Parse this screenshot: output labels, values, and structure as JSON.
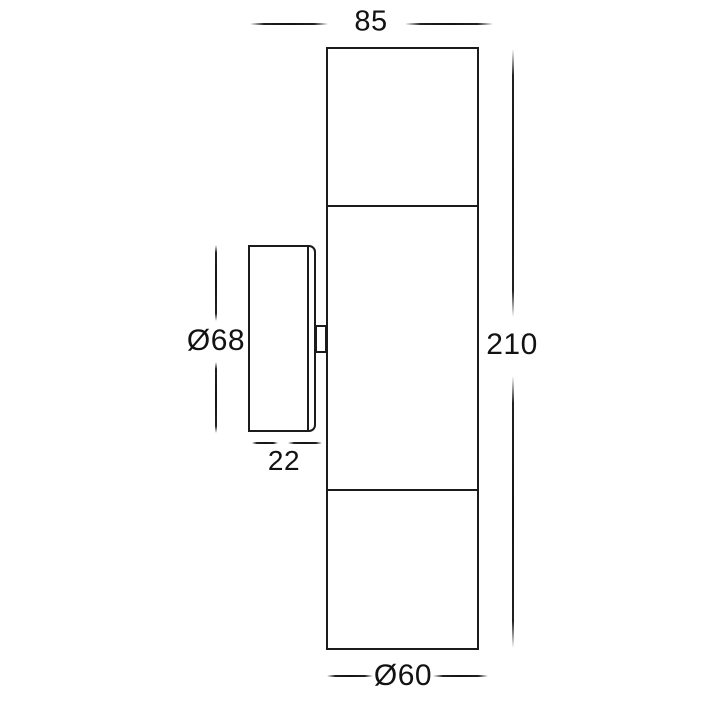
{
  "drawing": {
    "type": "technical-dimension-diagram",
    "views": {
      "front_view": "up-down wall light fixture body, three stacked sections",
      "side_view": "round mounting plate with wall tab"
    },
    "colors": {
      "line": "#1b1b1b",
      "text": "#121212",
      "background": "#ffffff"
    }
  },
  "dimensions": {
    "top_width": "85",
    "overall_height": "210",
    "plate_diameter": "Ø68",
    "plate_depth": "22",
    "base_diameter": "Ø60"
  }
}
